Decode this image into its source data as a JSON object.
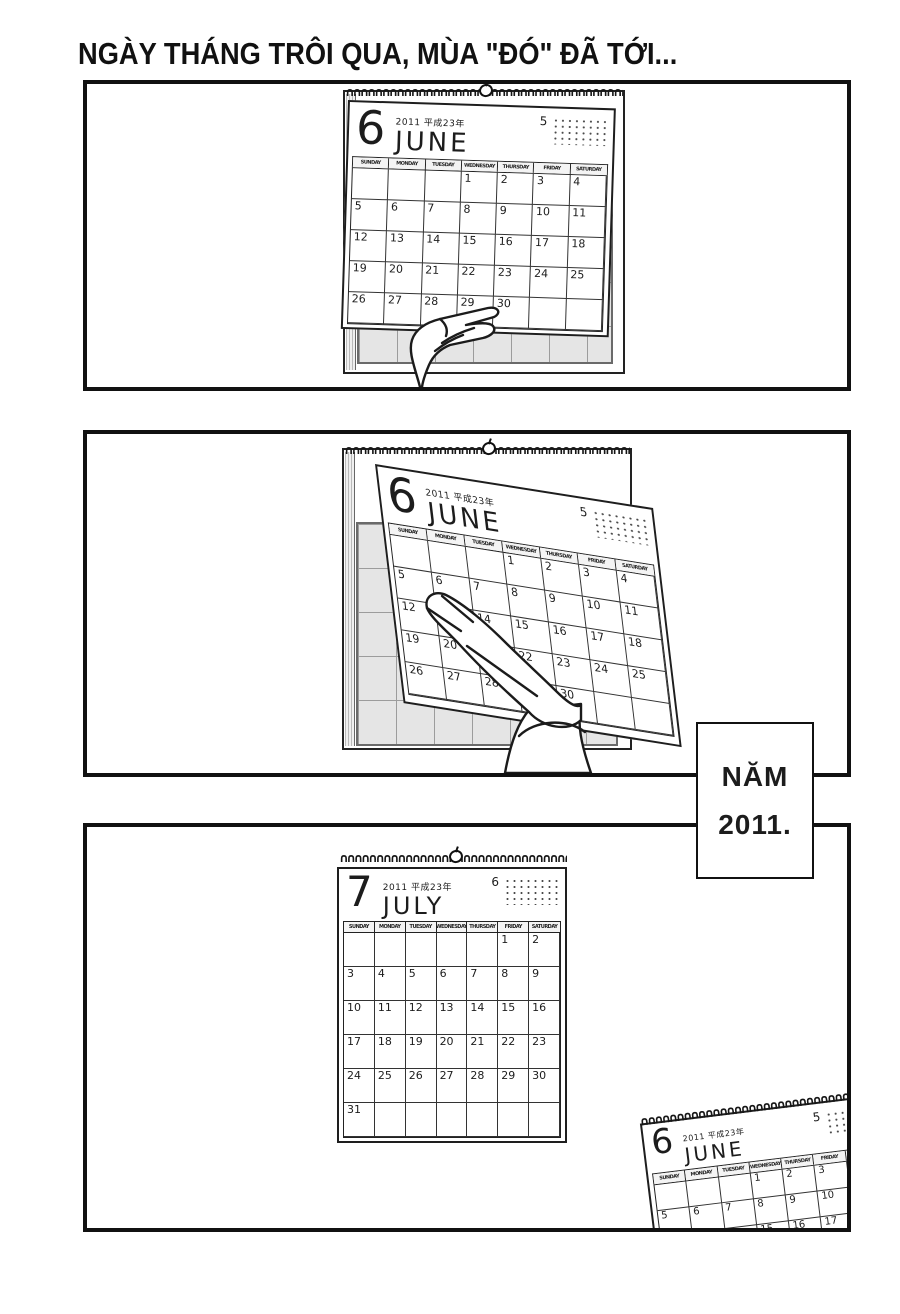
{
  "title": "NGÀY THÁNG TRÔI QUA, MÙA \"ĐÓ\" ĐÃ TỚI...",
  "caption_box": {
    "line1": "NĂM",
    "line2": "2011."
  },
  "weekday_labels": [
    "SUNDAY",
    "MONDAY",
    "TUESDAY",
    "WEDNESDAY",
    "THURSDAY",
    "FRIDAY",
    "SATURDAY"
  ],
  "calendars": {
    "june": {
      "month_digit": "6",
      "year_label": "2011 平成23年",
      "month_name": "JUNE",
      "mini_month_label": "5",
      "weeks": [
        [
          "",
          "",
          "",
          "1",
          "2",
          "3",
          "4"
        ],
        [
          "5",
          "6",
          "7",
          "8",
          "9",
          "10",
          "11"
        ],
        [
          "12",
          "13",
          "14",
          "15",
          "16",
          "17",
          "18"
        ],
        [
          "19",
          "20",
          "21",
          "22",
          "23",
          "24",
          "25"
        ],
        [
          "26",
          "27",
          "28",
          "29",
          "30",
          "",
          ""
        ]
      ]
    },
    "july": {
      "month_digit": "7",
      "year_label": "2011 平成23年",
      "month_name": "JULY",
      "mini_month_label": "6",
      "weeks": [
        [
          "",
          "",
          "",
          "",
          "",
          "1",
          "2"
        ],
        [
          "3",
          "4",
          "5",
          "6",
          "7",
          "8",
          "9"
        ],
        [
          "10",
          "11",
          "12",
          "13",
          "14",
          "15",
          "16"
        ],
        [
          "17",
          "18",
          "19",
          "20",
          "21",
          "22",
          "23"
        ],
        [
          "24",
          "25",
          "26",
          "27",
          "28",
          "29",
          "30"
        ],
        [
          "31",
          "",
          "",
          "",
          "",
          "",
          ""
        ]
      ]
    }
  },
  "icons": {
    "spiral_glyph": "∩"
  },
  "colors": {
    "ink": "#1c1c1c",
    "paper": "#ffffff",
    "backing_fill": "#e5e5e5",
    "backing_grid_line": "#9c9c9c"
  }
}
